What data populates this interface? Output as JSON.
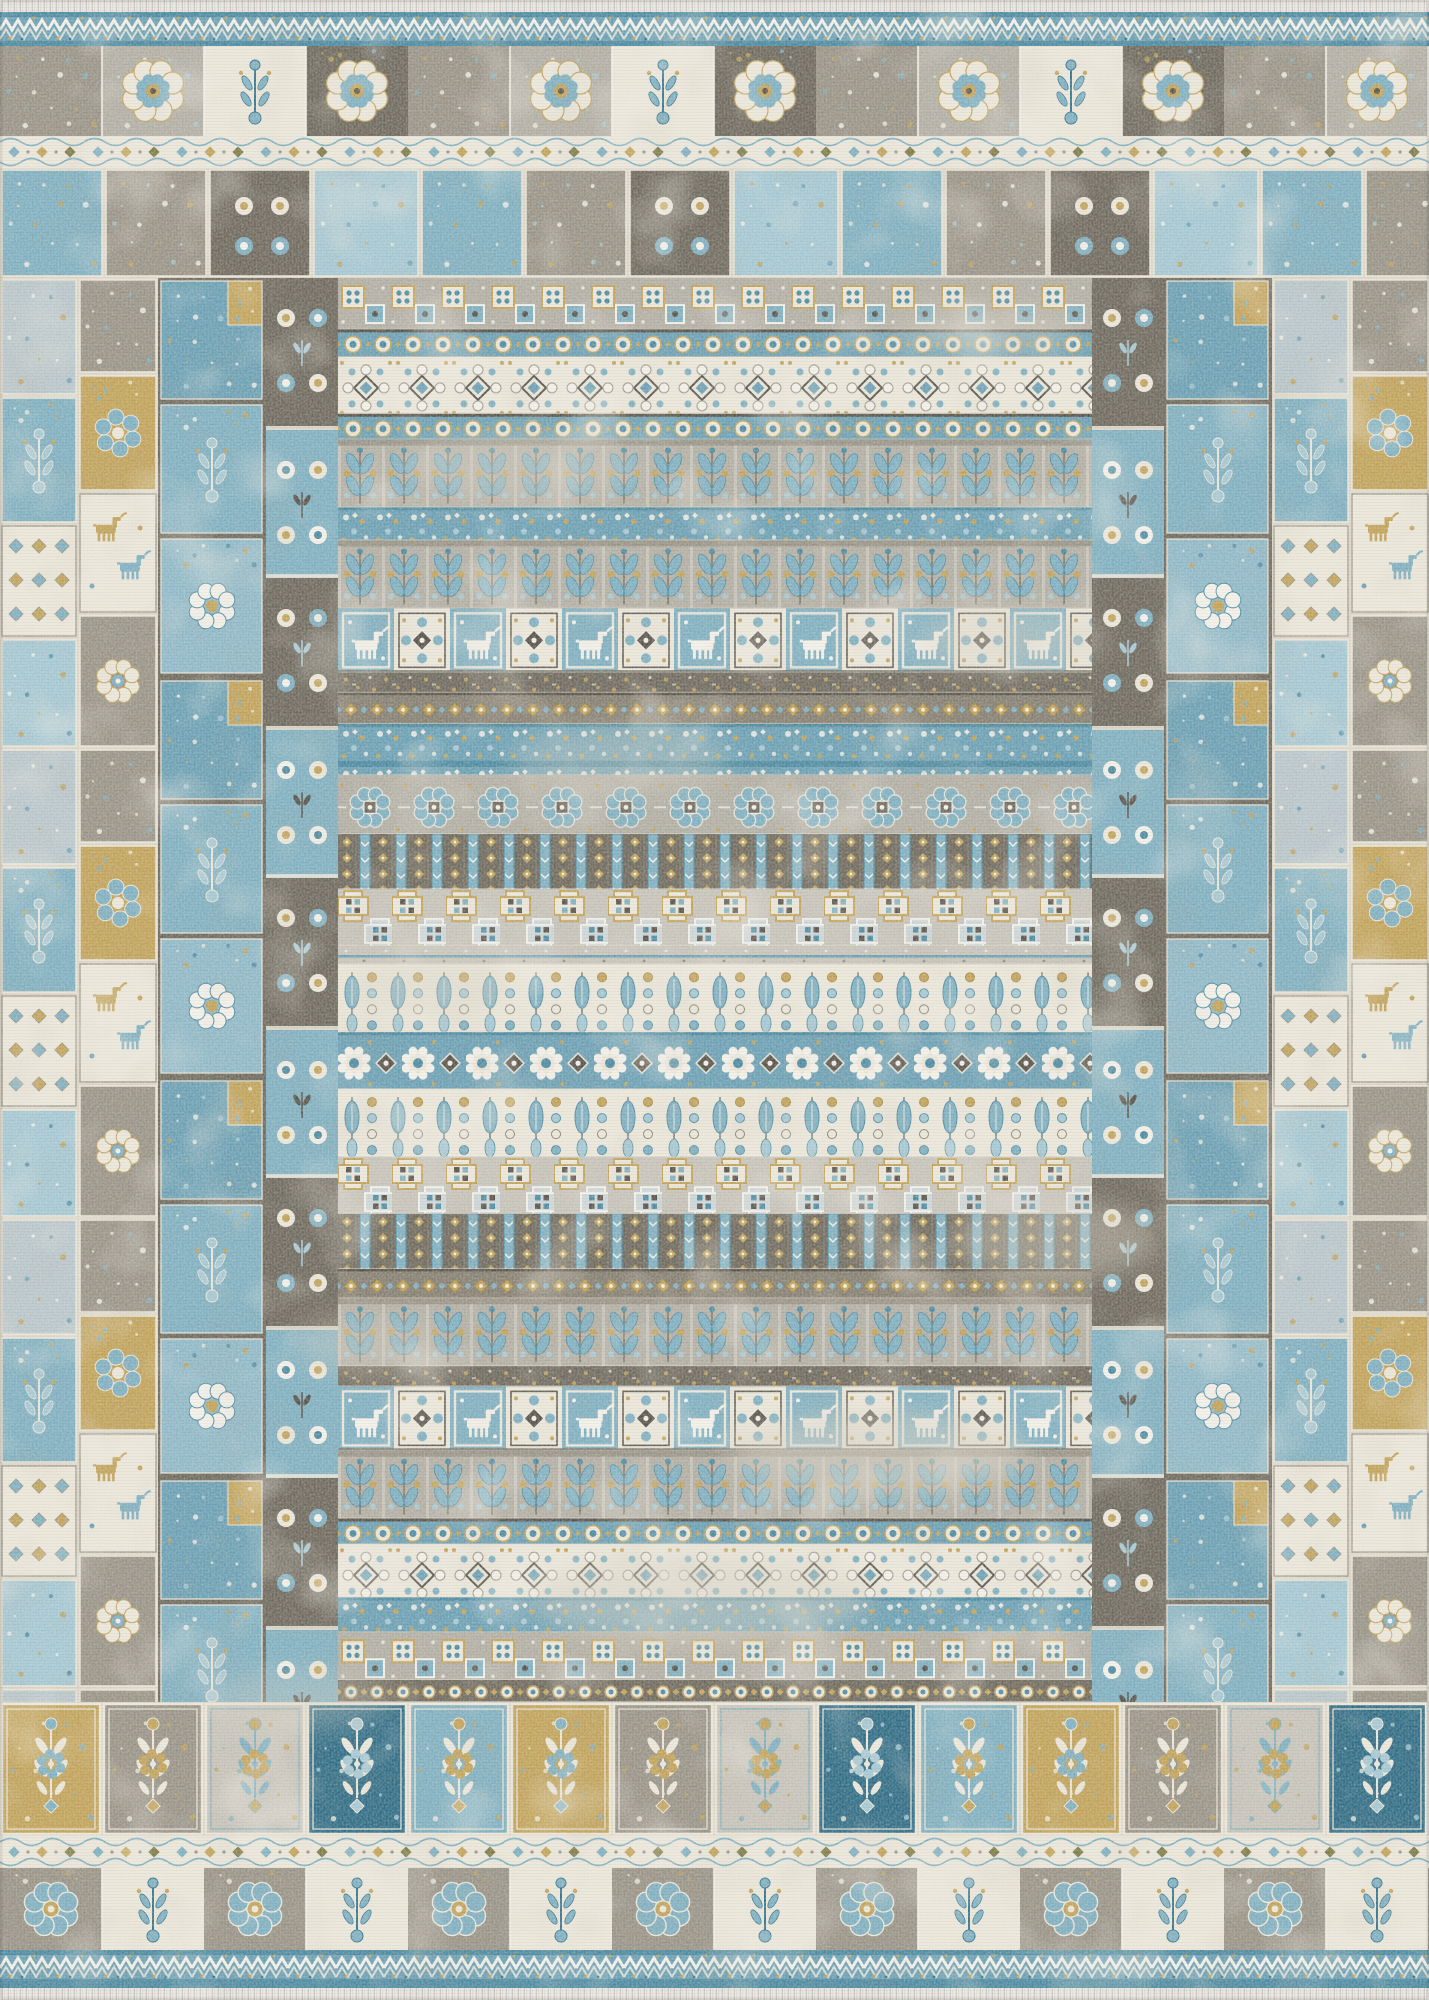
{
  "image": {
    "kind": "product-photo",
    "subject": "Distressed vintage patchwork area rug in blue, gold, gray and ivory",
    "orientation": "portrait",
    "width": 1429,
    "height": 2000
  },
  "palette": {
    "ivory": "#ebe7db",
    "white": "#f3f1ea",
    "cream": "#ddd8ca",
    "light_gray": "#c7c4bb",
    "mid_gray": "#b2afa5",
    "warm_gray": "#999488",
    "stone": "#857f72",
    "dark_taupe": "#6e695e",
    "deep_taupe": "#56524a",
    "steel_blue": "#7fb0c2",
    "light_blue": "#a5c8d4",
    "mid_blue": "#6aa0b5",
    "teal": "#4b8aa2",
    "deep_teal": "#35768f",
    "navy": "#2e6c86",
    "gold": "#c2a35a",
    "dark_gold": "#a5893f",
    "olive": "#7e7c49",
    "fringe_bg": "#eceae6",
    "fringe_line": "#c9c7c1",
    "wear": "#d8d3c6"
  },
  "layout": {
    "width": 1429,
    "height": 2000,
    "rows": {
      "fringe_top": [
        0,
        12
      ],
      "zigzag_top": [
        12,
        46
      ],
      "medallion_row": [
        46,
        136
      ],
      "diamond_top": [
        136,
        168
      ],
      "patch_strip": [
        168,
        278
      ],
      "body": [
        278,
        1702
      ],
      "big_tiles": [
        1702,
        1836
      ],
      "diamond_bottom": [
        1836,
        1868
      ],
      "rosette_row": [
        1868,
        1950
      ],
      "zigzag_bottom": [
        1950,
        1988
      ],
      "fringe_bottom": [
        1988,
        2000
      ]
    },
    "columns": {
      "patch_left": [
        0,
        158
      ],
      "patch_blue_left": [
        158,
        266
      ],
      "flower_left": [
        266,
        338
      ],
      "field": [
        338,
        1092
      ],
      "flower_right": [
        1092,
        1164
      ],
      "patch_blue_right": [
        1164,
        1272
      ],
      "patch_right": [
        1272,
        1429
      ]
    }
  },
  "field_bands": [
    {
      "type": "tilerow",
      "h": 56
    },
    {
      "type": "beads",
      "h": 30
    },
    {
      "type": "ivoryrosette",
      "h": 62
    },
    {
      "type": "beads",
      "h": 28
    },
    {
      "type": "columns",
      "h": 74
    },
    {
      "type": "bluedense",
      "h": 36
    },
    {
      "type": "columns",
      "h": 74
    },
    {
      "type": "animals",
      "h": 70
    },
    {
      "type": "darksep",
      "h": 22
    },
    {
      "type": "golddiamond",
      "h": 34
    },
    {
      "type": "bluedense",
      "h": 56
    },
    {
      "type": "rosettes",
      "h": 64
    },
    {
      "type": "lattice",
      "h": 60
    },
    {
      "type": "stepcross",
      "h": 62
    },
    {
      "type": "thinline",
      "h": 20
    },
    {
      "type": "feathers",
      "h": 74
    },
    {
      "type": "bluerosette",
      "h": 62
    },
    {
      "type": "feathers",
      "h": 74
    },
    {
      "type": "stepcross",
      "h": 62
    },
    {
      "type": "lattice",
      "h": 60
    },
    {
      "type": "golddiamond",
      "h": 32
    },
    {
      "type": "columns",
      "h": 74
    },
    {
      "type": "darksep",
      "h": 22
    },
    {
      "type": "animals",
      "h": 70
    },
    {
      "type": "columns",
      "h": 74
    },
    {
      "type": "beads",
      "h": 28
    },
    {
      "type": "ivoryrosette",
      "h": 58
    },
    {
      "type": "bluedense",
      "h": 38
    },
    {
      "type": "tilerow",
      "h": 52
    },
    {
      "type": "darkbead",
      "h": 24
    }
  ],
  "top_tile_sequence": [
    "floral-gray",
    "medallion-light",
    "vase-white",
    "medallion-dark"
  ],
  "bottom_tile_sequence": [
    "rosette-gray",
    "stem-white"
  ],
  "bottom_large_tiles": [
    "gold-medallion",
    "gray-damask",
    "silver-damask",
    "navy-damask",
    "blue-damask"
  ],
  "wear_spots": [
    {
      "x": 880,
      "y": 1455,
      "rx": 150,
      "ry": 42,
      "o": 0.5
    },
    {
      "x": 520,
      "y": 468,
      "rx": 120,
      "ry": 34,
      "o": 0.4
    },
    {
      "x": 1010,
      "y": 640,
      "rx": 95,
      "ry": 30,
      "o": 0.38
    },
    {
      "x": 700,
      "y": 1600,
      "rx": 170,
      "ry": 45,
      "o": 0.45
    },
    {
      "x": 430,
      "y": 985,
      "rx": 85,
      "ry": 30,
      "o": 0.35
    },
    {
      "x": 1055,
      "y": 1240,
      "rx": 105,
      "ry": 40,
      "o": 0.4
    },
    {
      "x": 370,
      "y": 1345,
      "rx": 75,
      "ry": 28,
      "o": 0.35
    },
    {
      "x": 985,
      "y": 332,
      "rx": 95,
      "ry": 26,
      "o": 0.35
    },
    {
      "x": 620,
      "y": 760,
      "rx": 110,
      "ry": 32,
      "o": 0.35
    },
    {
      "x": 300,
      "y": 1700,
      "rx": 90,
      "ry": 30,
      "o": 0.3
    }
  ]
}
